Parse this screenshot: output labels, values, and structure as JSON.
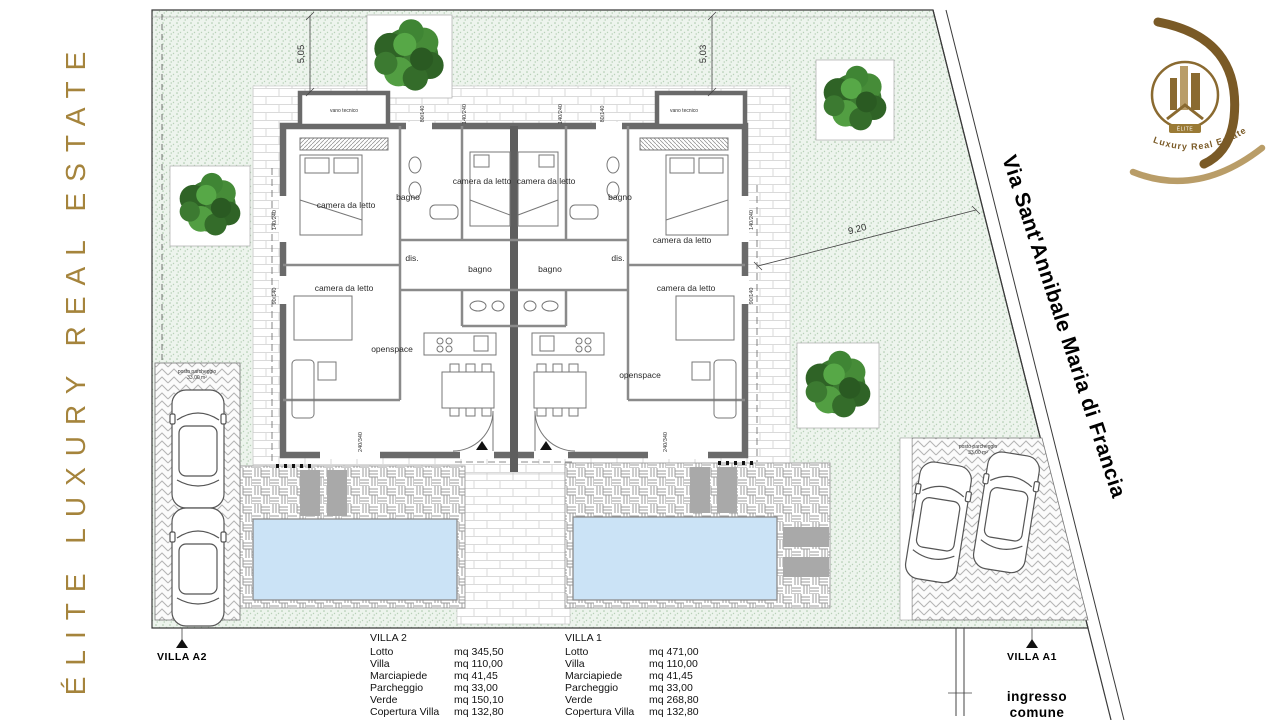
{
  "brand": {
    "vertical_text": "ÉLITE LUXURY REAL ESTATE"
  },
  "logo": {
    "banner_text": "ÉLITE",
    "tagline": "Luxury Real Estate"
  },
  "street": {
    "name": "Via Sant'Annibale Maria di Francia"
  },
  "plan": {
    "room_labels": {
      "bedroom": "camera da letto",
      "bathroom": "bagno",
      "hall": "dis.",
      "openspace": "openspace",
      "technical": "vano tecnico"
    },
    "dimensions": {
      "left_height": "5,05",
      "right_height": "5,03",
      "street_distance": "9.20"
    },
    "window_dims": {
      "w140_240": "140/240",
      "w90_140": "90/140",
      "w80_140": "80/140",
      "w240_340": "240/340"
    },
    "parking_label_line1": "posto parcheggio",
    "parking_label_line2": "33,00 m²",
    "markers": {
      "villa_a2": "VILLA A2",
      "villa_a1": "VILLA A1",
      "entrance_line1": "ingresso",
      "entrance_line2": "comune"
    }
  },
  "tables": {
    "villa2": {
      "title": "VILLA 2",
      "rows": [
        {
          "label": "Lotto",
          "value": "mq 345,50"
        },
        {
          "label": "Villa",
          "value": "mq 110,00"
        },
        {
          "label": "Marciapiede",
          "value": "mq  41,45"
        },
        {
          "label": "Parcheggio",
          "value": "mq  33,00"
        },
        {
          "label": "Verde",
          "value": "mq 150,10"
        },
        {
          "label": "Copertura Villa",
          "value": "mq 132,80"
        }
      ]
    },
    "villa1": {
      "title": "VILLA 1",
      "rows": [
        {
          "label": "Lotto",
          "value": "mq 471,00"
        },
        {
          "label": "Villa",
          "value": "mq 110,00"
        },
        {
          "label": "Marciapiede",
          "value": "mq 41,45"
        },
        {
          "label": "Parcheggio",
          "value": "mq 33,00"
        },
        {
          "label": "Verde",
          "value": "mq 268,80"
        },
        {
          "label": "Copertura Villa",
          "value": "mq 132,80"
        }
      ]
    }
  },
  "colors": {
    "brand_gold": "#A5843C",
    "logo_dark_gold": "#7A5A26",
    "logo_tan": "#B99D68",
    "pool_blue": "#CBE3F6",
    "site_green": "#EDF4ED"
  }
}
